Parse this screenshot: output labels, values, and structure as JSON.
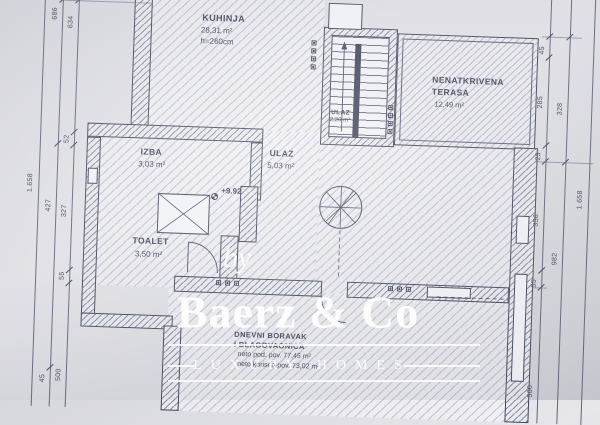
{
  "watermark": {
    "prefix": "by",
    "brand": "Baerz & Co",
    "tagline": "LUXURY HOMES"
  },
  "rooms": {
    "kuhinja": {
      "name": "KUHINJA",
      "area": "28,31 m²",
      "height": "h=260cm"
    },
    "terasa": {
      "name_line1": "NENATKRIVENA",
      "name_line2": "TERASA",
      "area": "12,49 m²"
    },
    "ulaz_stubiste": {
      "name": "ULAZ",
      "area": "2,20 m²"
    },
    "izba": {
      "name": "IZBA",
      "area": "3,03 m²"
    },
    "ulaz": {
      "name": "ULAZ",
      "area": "5,03 m²"
    },
    "toalet": {
      "name": "TOALET",
      "area": "3,50 m²"
    },
    "dnevni": {
      "name_line1": "DNEVNI BORAVAK",
      "name_line2": "I BLAGOVAONICA",
      "area_line1": "neto pod. pov. 77,45 m²",
      "area_line2": "neto korisna pov. 73,02 m²"
    }
  },
  "annotations": {
    "elevation": "+9.92"
  },
  "dimensions": {
    "left_far": "1.658",
    "left_outer": [
      "686",
      "427",
      "45"
    ],
    "left_inner": [
      "634",
      "52",
      "327",
      "55",
      "500"
    ],
    "right_inner": [
      "45",
      "285",
      "23",
      "356",
      "55",
      "500"
    ],
    "right_outer": [
      "328",
      "982"
    ],
    "right_far": "1.658"
  },
  "colors": {
    "paper": "#dfe0e5",
    "ink": "#3e4457",
    "watermark": "#ffffff"
  }
}
